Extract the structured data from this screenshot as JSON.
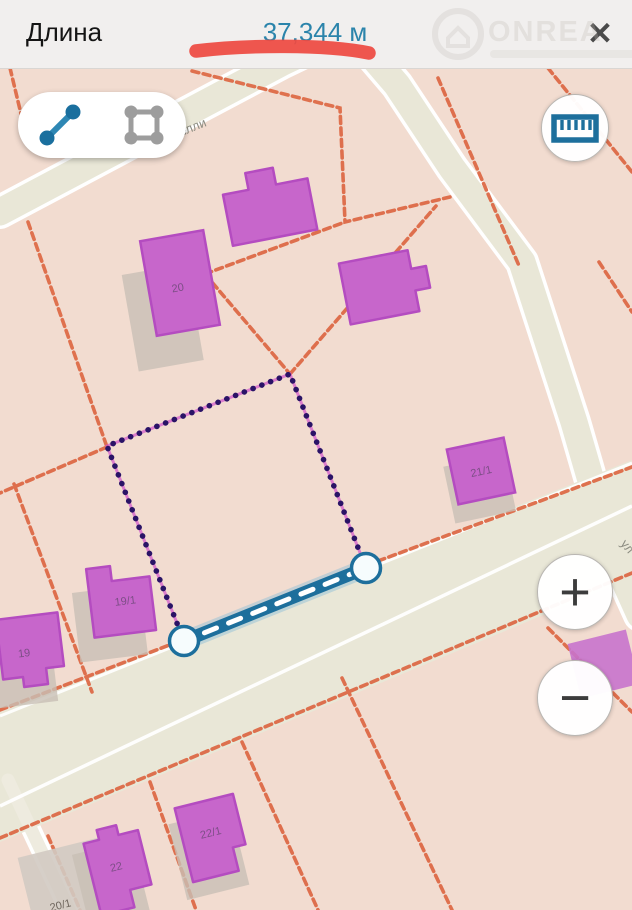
{
  "header": {
    "title": "Длина",
    "value": "37,344 м",
    "close_glyph": "✕",
    "watermark_brand": "ONREA",
    "value_color": "#2b84ab",
    "annotation_color": "#ee4a42"
  },
  "toolbar": {
    "tools": [
      {
        "name": "measure-distance",
        "active": true
      },
      {
        "name": "measure-area",
        "active": false
      }
    ]
  },
  "controls": {
    "zoom_in_glyph": "+",
    "zoom_out_glyph": "−"
  },
  "map": {
    "street_labels": [
      {
        "text": "уставелли"
      },
      {
        "text": "ул"
      }
    ],
    "buildings": [
      {
        "label": "20"
      },
      {
        "label": "21/1"
      },
      {
        "label": "19/1"
      },
      {
        "label": "19"
      },
      {
        "label": "22"
      },
      {
        "label": "22/1"
      },
      {
        "label": "20/1"
      }
    ],
    "measurement": {
      "selected_segment_length": "37,344",
      "unit": "м",
      "vertices": 4
    },
    "colors": {
      "parcel_fill": "#f2dcd0",
      "road_fill": "#e9e7d7",
      "boundary_orange": "#dd6a47",
      "building_fill": "#c766cb",
      "building_stroke": "#b44cc0",
      "measure_blue": "#1d6f9c",
      "dot_navy": "#2a1366",
      "selection_magenta": "#d356cc"
    }
  }
}
